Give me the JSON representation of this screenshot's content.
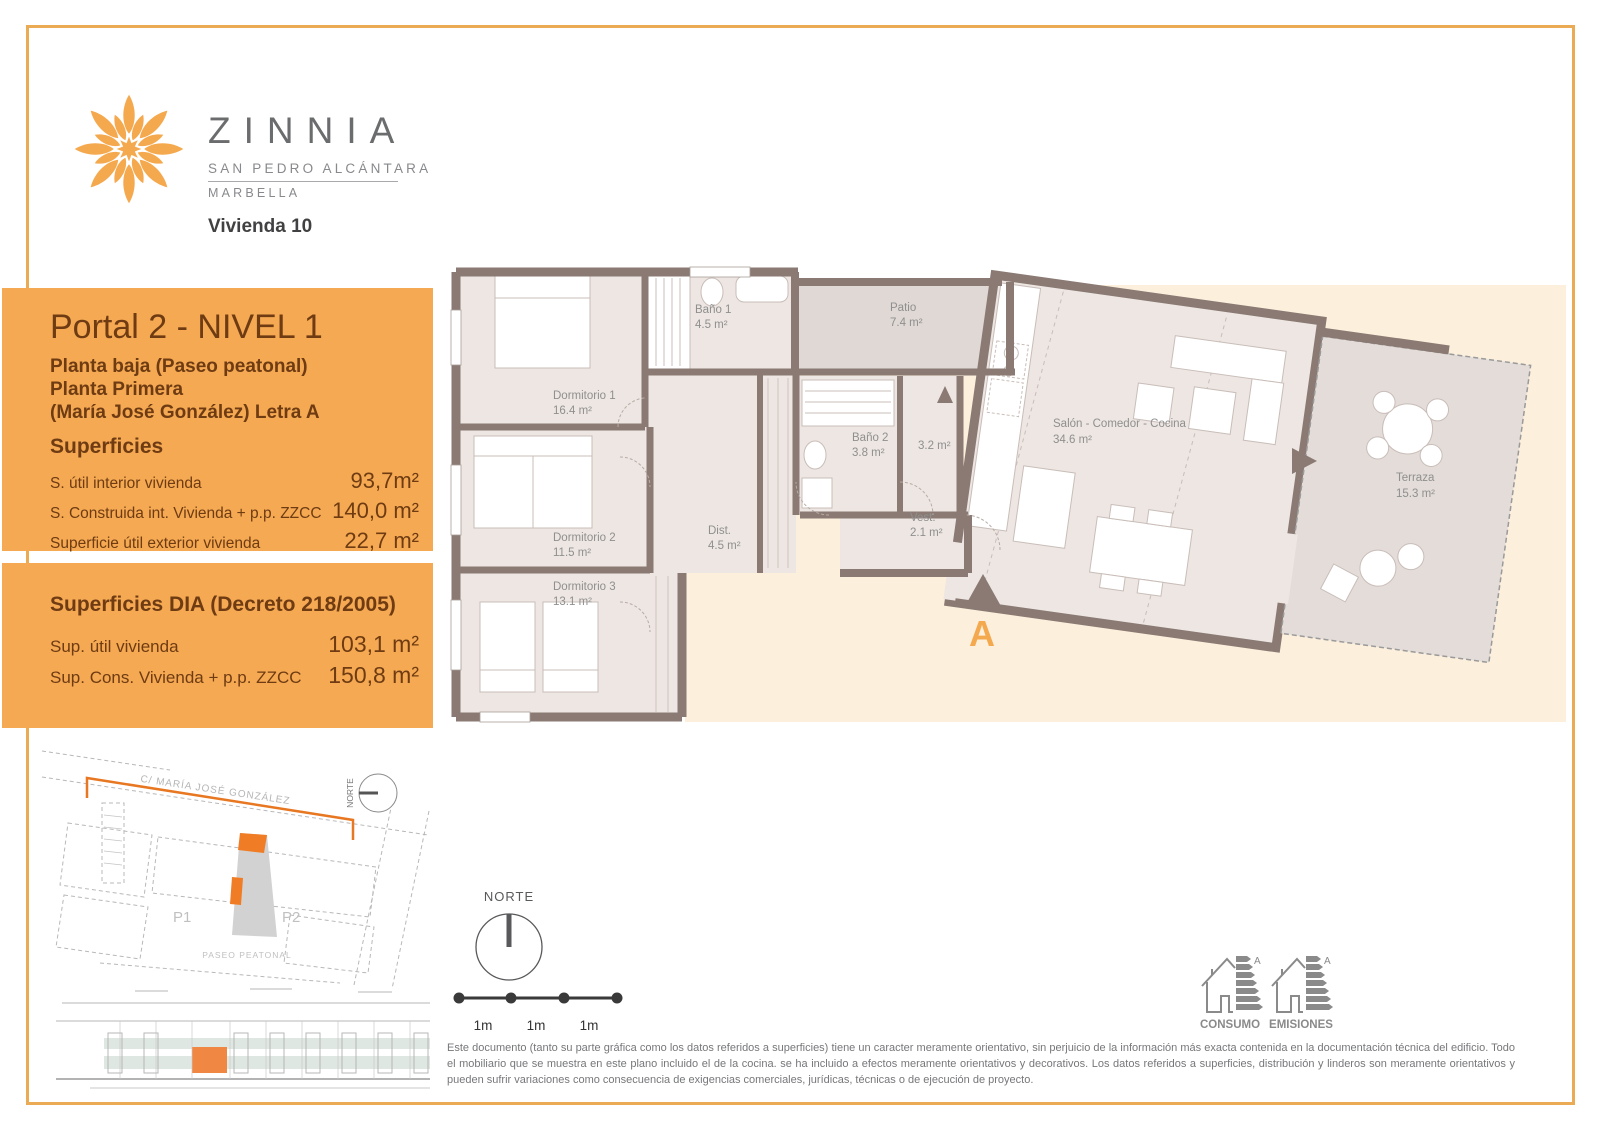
{
  "colors": {
    "accent_orange": "#F5A952",
    "border_orange": "#EBAB55",
    "panel_text_brown": "#6E3B13",
    "logo_orange": "#F5A94E",
    "site_highlight_orange": "#F07D26",
    "wall_taupe": "#8A7A73",
    "room_fill": "#EDE6E2",
    "patio_fill": "#DFD8D4",
    "terrace_fill": "#E3DCD8",
    "peach_background": "#FCEFDC",
    "brand_gray": "#6A6C6E"
  },
  "header": {
    "brand": "ZINNIA",
    "location": "SAN PEDRO ALCÁNTARA",
    "city": "MARBELLA",
    "unit": "Vivienda 10"
  },
  "info_panel": {
    "title": "Portal 2 - NIVEL 1",
    "subtitle_lines": [
      "Planta baja (Paseo peatonal)",
      "Planta Primera",
      "(María José González) Letra A"
    ],
    "section": "Superficies",
    "rows": [
      {
        "label": "S. útil interior vivienda",
        "value": "93,7m²"
      },
      {
        "label": "S. Construida int. Vivienda + p.p. ZZCC",
        "value": "140,0 m²"
      },
      {
        "label": "Superficie útil exterior vivienda",
        "value": "22,7 m²"
      }
    ]
  },
  "dia_panel": {
    "title": "Superficies DIA (Decreto 218/2005)",
    "rows": [
      {
        "label": "Sup. útil vivienda",
        "value": "103,1 m²"
      },
      {
        "label": "Sup. Cons. Vivienda + p.p. ZZCC",
        "value": "150,8 m²"
      }
    ]
  },
  "floor_plan": {
    "rooms": [
      {
        "name": "Dormitorio 1",
        "area": "16.4 m²"
      },
      {
        "name": "Baño 1",
        "area": "4.5 m²"
      },
      {
        "name": "Patio",
        "area": "7.4 m²"
      },
      {
        "name": "Dormitorio 2",
        "area": "11.5 m²"
      },
      {
        "name": "Dormitorio 3",
        "area": "13.1 m²"
      },
      {
        "name": "Dist.",
        "area": "4.5 m²"
      },
      {
        "name": "Baño 2",
        "area": "3.8 m²"
      },
      {
        "name": "",
        "area": "3.2 m²"
      },
      {
        "name": "Vest.",
        "area": "2.1 m²"
      },
      {
        "name": "Salón - Comedor - Cocina",
        "area": "34.6 m²"
      },
      {
        "name": "Terraza",
        "area": "15.3 m²"
      }
    ],
    "entrance_label": "A"
  },
  "site_plan": {
    "street": "C/ MARÍA JOSÉ GONZÁLEZ",
    "portal1": "P1",
    "portal2": "P2",
    "paseo": "PASEO PEATONAL",
    "north_label": "NORTE"
  },
  "compass": {
    "label": "NORTE"
  },
  "scale_bar": {
    "segments": [
      "1m",
      "1m",
      "1m"
    ]
  },
  "energy": {
    "consumo_label": "CONSUMO",
    "emisiones_label": "EMISIONES",
    "rating": "A"
  },
  "disclaimer": "Este documento (tanto su parte gráfica como los datos referidos a superficies) tiene un caracter meramente orientativo, sin perjuicio de la información más exacta contenida en la documentación técnica del edificio. Todo el mobiliario que se muestra en este plano incluido el de la cocina. se ha incluido a efectos meramente orientativos y decorativos. Los datos referidos a superficies, distribución y linderos son meramente orientativos y pueden sufrir variaciones como consecuencia de exigencias comerciales, jurídicas, técnicas o de ejecución de proyecto."
}
